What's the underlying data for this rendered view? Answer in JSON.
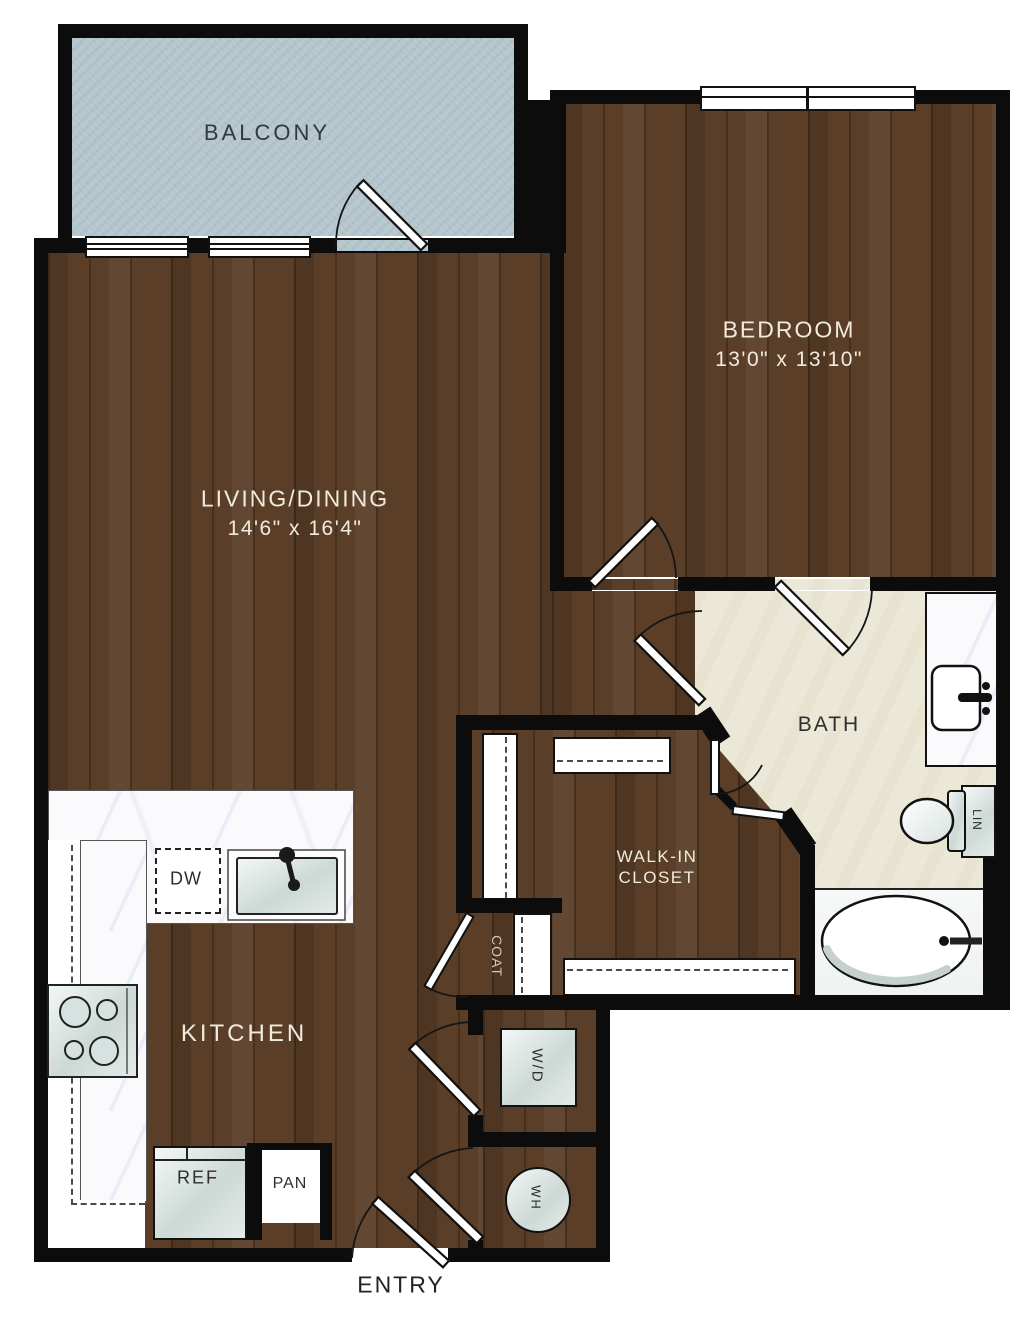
{
  "rooms": {
    "balcony": {
      "label": "BALCONY"
    },
    "living_dining": {
      "label": "LIVING/DINING",
      "dims": "14'6\" x 16'4\""
    },
    "bedroom": {
      "label": "BEDROOM",
      "dims": "13'0\" x 13'10\""
    },
    "bath": {
      "label": "BATH"
    },
    "walk_in_closet": {
      "line1": "WALK-IN",
      "line2": "CLOSET"
    },
    "kitchen": {
      "label": "KITCHEN"
    },
    "entry": {
      "label": "ENTRY"
    },
    "coat": {
      "label": "COAT"
    }
  },
  "fixtures": {
    "dishwasher": "DW",
    "refrigerator": "REF",
    "pantry": "PAN",
    "washer_dryer": "W/D",
    "water_heater": "WH",
    "linen": "LIN"
  },
  "colors": {
    "wall": "#0c0c0c",
    "wood_floor": "#5a3e27",
    "balcony_floor": "#b5c6cd",
    "bath_floor": "#ece8d7",
    "counter_marble": "#fafafd",
    "label_light": "#f1ebdf",
    "label_dark": "#2e2e2e"
  }
}
